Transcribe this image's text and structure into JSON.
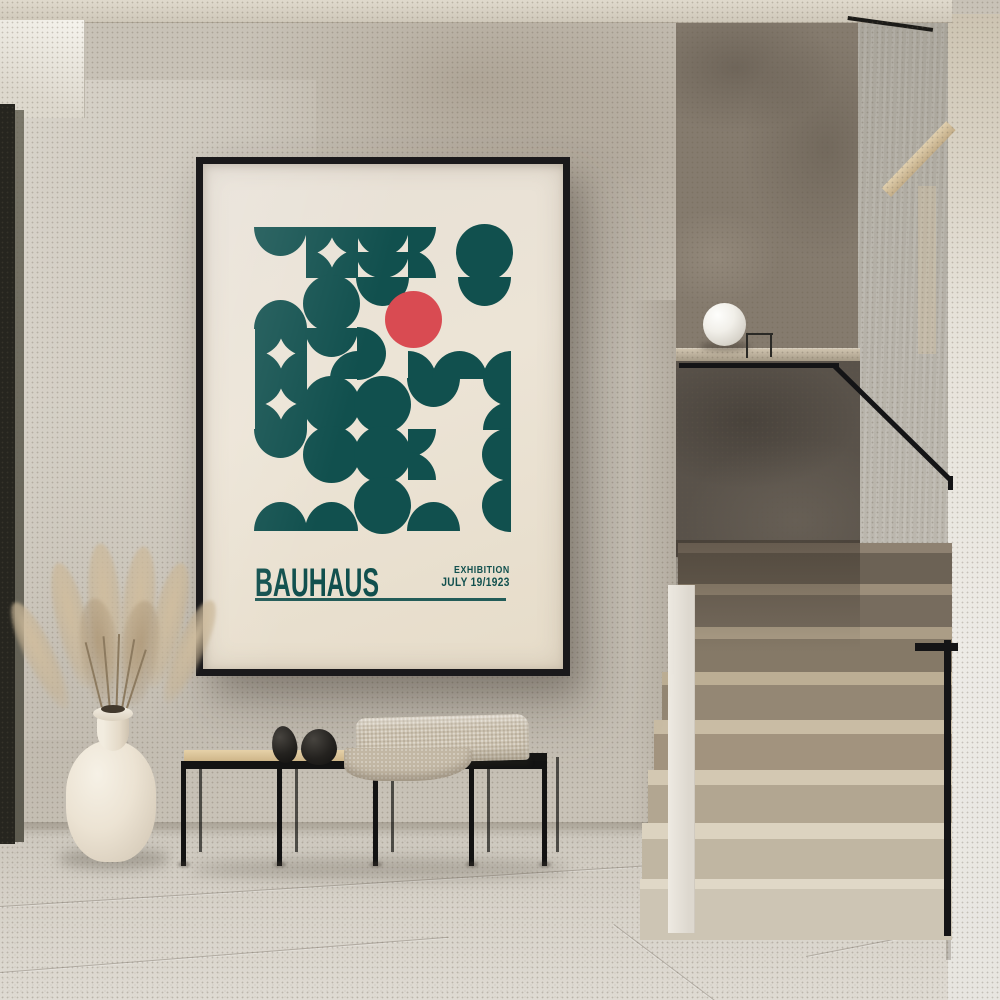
{
  "poster": {
    "title": "BAUHAUS",
    "exhibition_label": "EXHIBITION",
    "date_label": "JULY 19/1923",
    "colors": {
      "teal": "#11504E",
      "red": "#D94B52",
      "paper": "#EBE3D5",
      "frame": "#1A191B"
    },
    "pattern": {
      "cols": 5,
      "rows": 6,
      "shape_legend": [
        "circle",
        "semi-down",
        "semi-up",
        "semi-left",
        "semi-right",
        "semi-down-pair",
        "semi-down-br",
        "quarters-left",
        "quarters-right",
        "valley",
        "quad",
        "red-spot"
      ],
      "grid": [
        [
          "semi-down",
          "quad",
          "semi-down-pair",
          "quarters-left",
          "circle"
        ],
        [
          "semi-up",
          "circle",
          "semi-down",
          "red-spot",
          "semi-down"
        ],
        [
          "quad",
          "semi-down-br",
          "semi-right",
          "valley",
          "valley"
        ],
        [
          "quad",
          "circle",
          "circle",
          "semi-down",
          "quarters-right"
        ],
        [
          "semi-down",
          "circle",
          "circle",
          "quarters-left",
          "semi-left"
        ],
        [
          "semi-up",
          "semi-up",
          "circle",
          "semi-up",
          "semi-left"
        ]
      ],
      "red_circle": {
        "row": 2,
        "col": 4
      }
    }
  },
  "palette": {
    "wall": "#C8C2B7",
    "stair_wall": "#857B6E",
    "parapet": "#59524A",
    "steps_light": "#D9D3C4",
    "steps_shadow": "#7E7265",
    "floor": "#D5D0C7",
    "ceiling": "#DCD6C9",
    "right_wall": "#EAE8E3",
    "wood": "#DDC69D",
    "metal": "#141416",
    "vase": "#EFE8DB",
    "blanket": "#CCC2B0"
  }
}
